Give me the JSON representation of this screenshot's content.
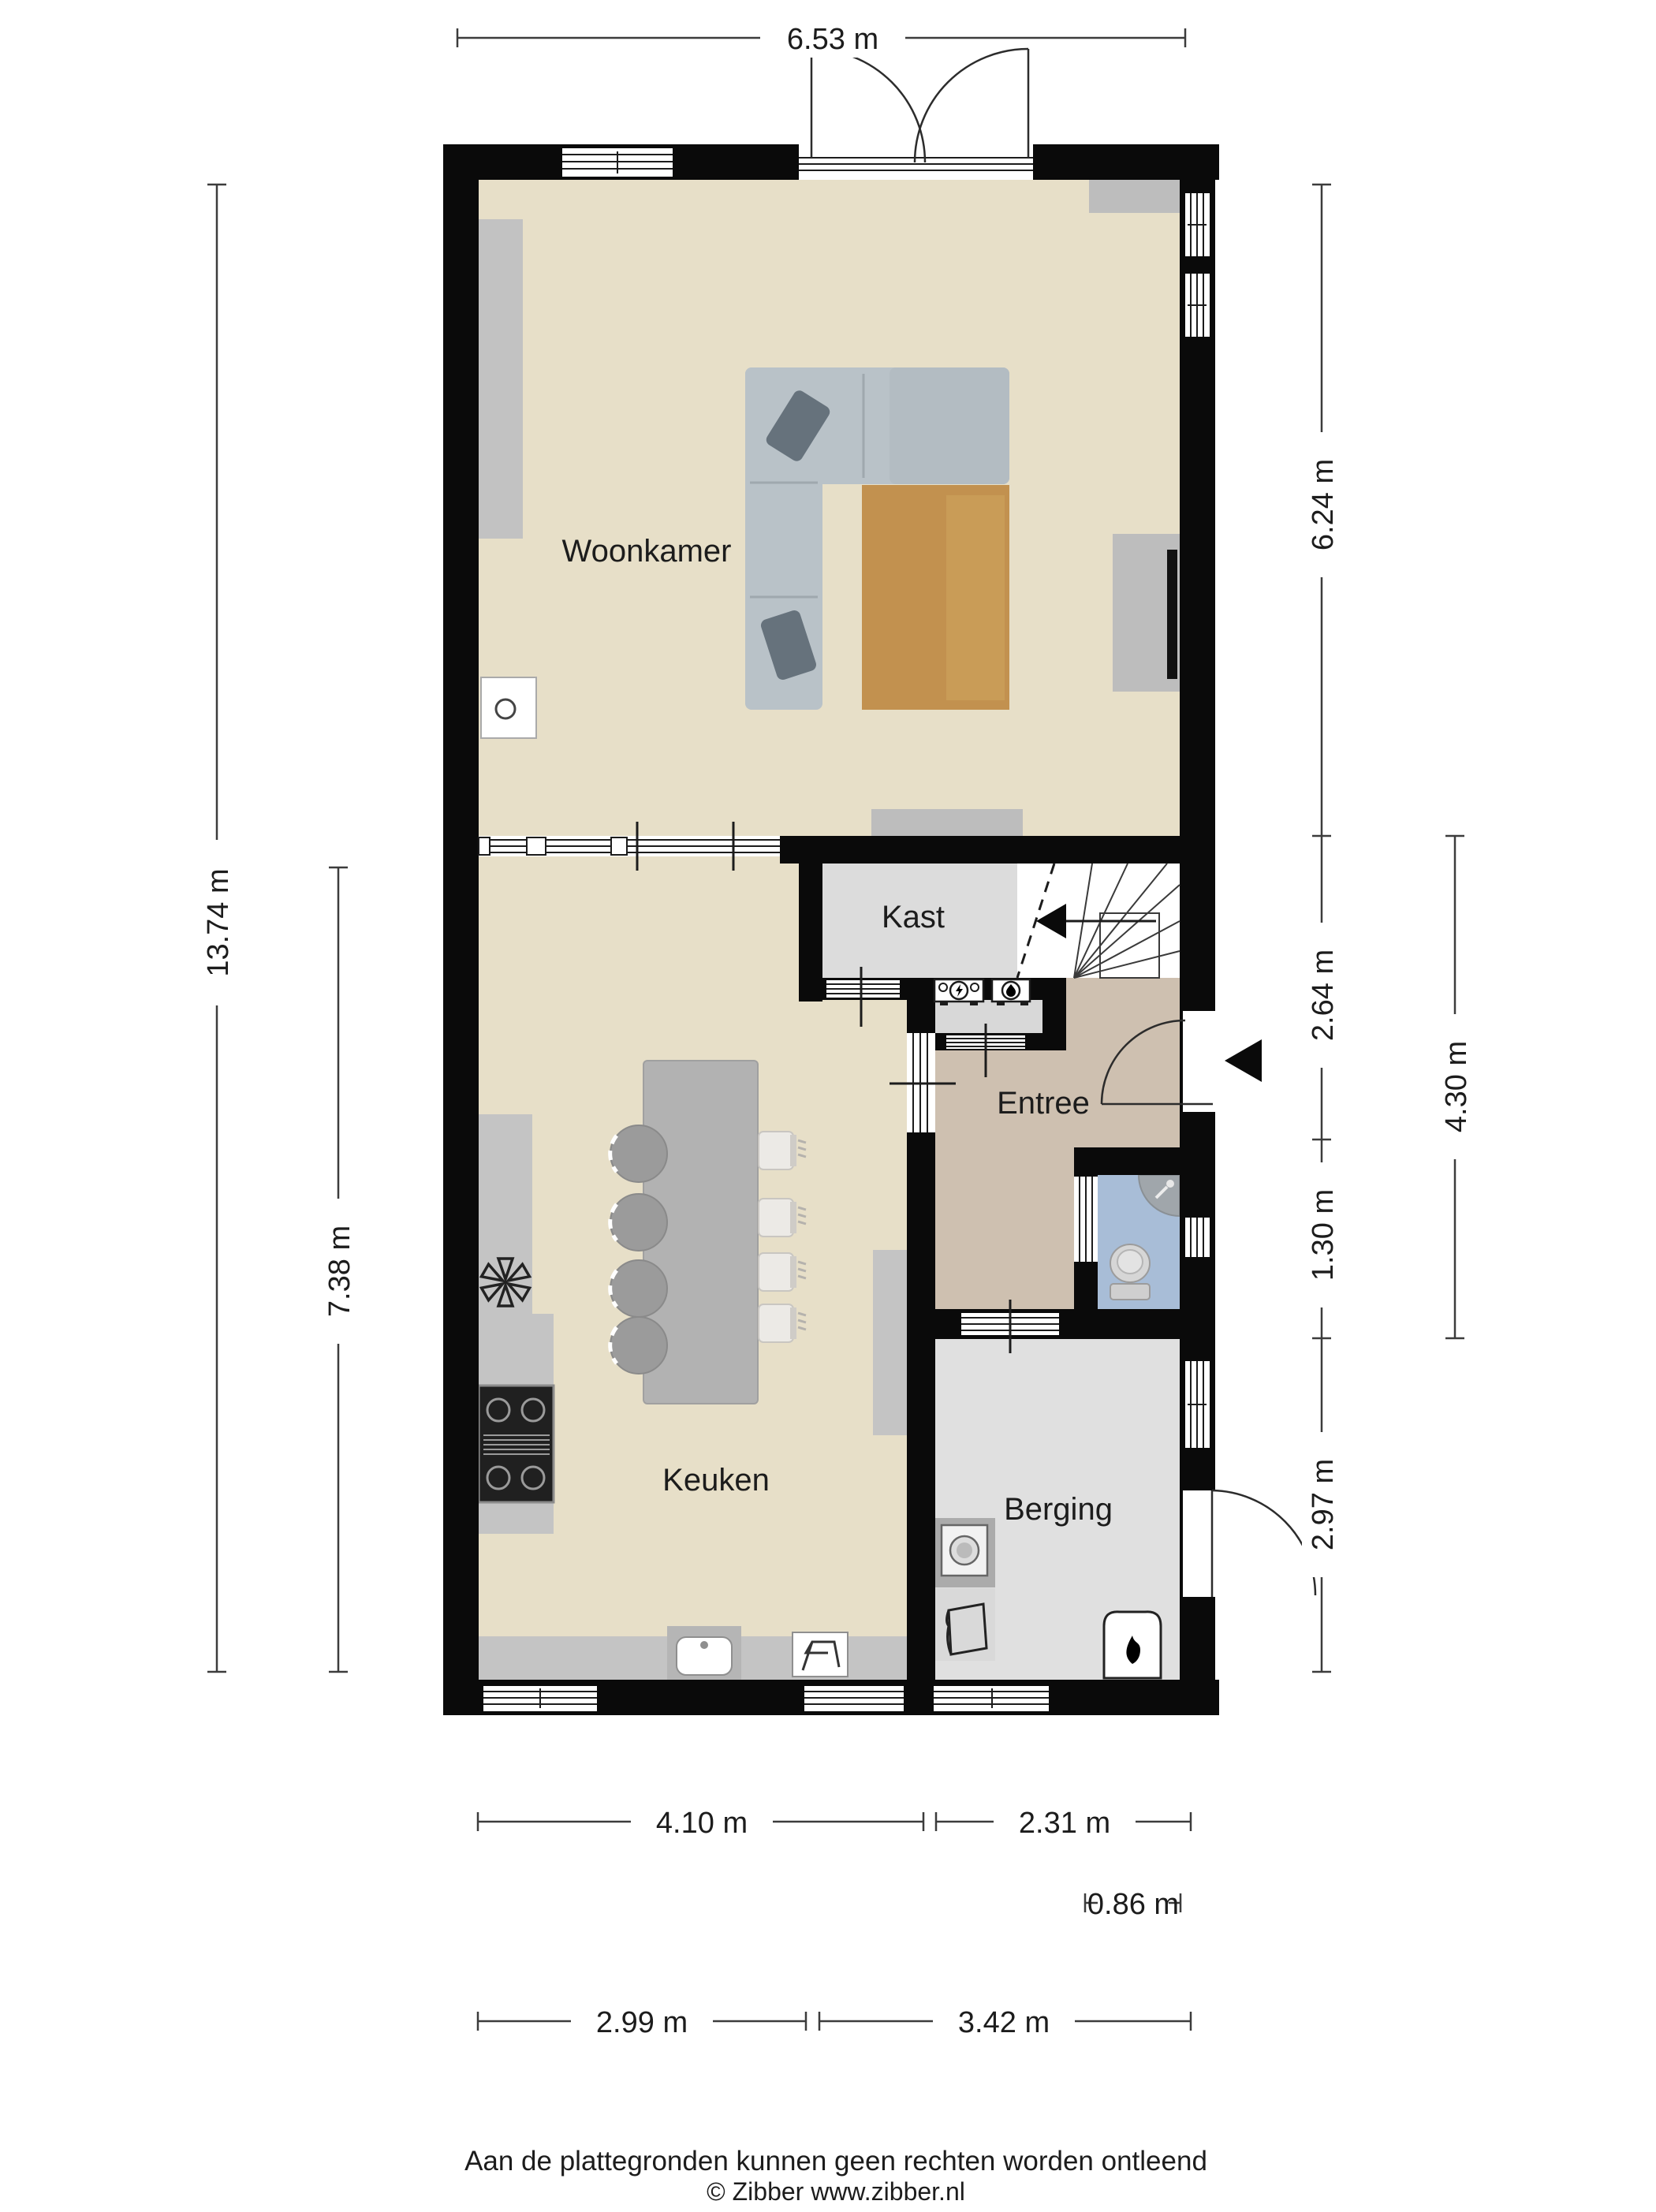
{
  "floorplan": {
    "rooms": {
      "woonkamer": "Woonkamer",
      "kast": "Kast",
      "entree": "Entree",
      "keuken": "Keuken",
      "berging": "Berging"
    },
    "dimensions": {
      "top_width": "6.53 m",
      "left_height_total": "13.74 m",
      "left_height_lower": "7.38 m",
      "right_livingroom": "6.24 m",
      "right_hall": "2.64 m",
      "right_toilet": "1.30 m",
      "right_storage": "2.97 m",
      "right_outer": "4.30 m",
      "bottom_kitchen": "4.10 m",
      "bottom_storage": "2.31 m",
      "bottom_offset": "0.86 m",
      "bottom_lower_left": "2.99 m",
      "bottom_lower_right": "3.42 m"
    },
    "footer": {
      "disclaimer": "Aan de plattegronden kunnen geen rechten worden ontleend",
      "credit": "© Zibber www.zibber.nl"
    },
    "colors": {
      "wall": "#0a0a0a",
      "living_floor": "#e7dfc8",
      "hall_floor": "#cec0b0",
      "closet_floor": "#dcdcdc",
      "storage_floor": "#e0e0e0",
      "toilet_floor": "#a8bdd7",
      "rug": "#c2914f",
      "sofa": "#b9c2c8"
    }
  }
}
